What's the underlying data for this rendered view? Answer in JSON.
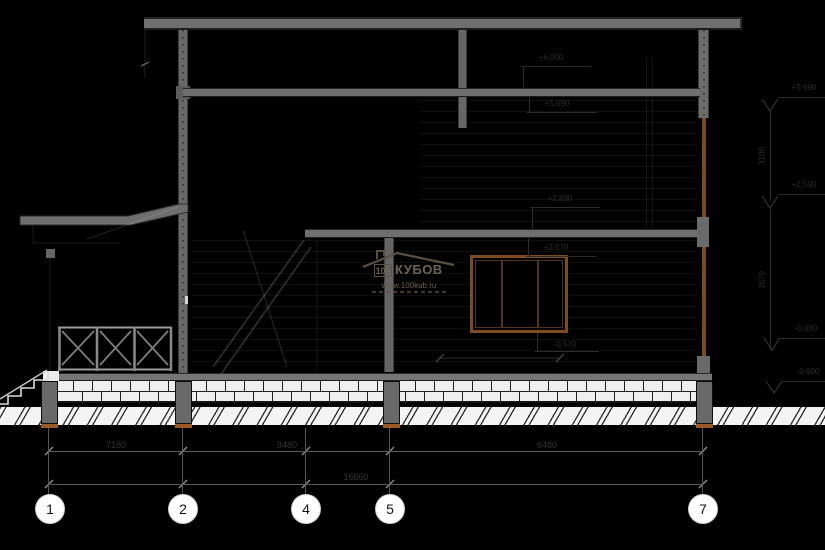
{
  "drawing": {
    "title": "building-section",
    "colors": {
      "background": "#000000",
      "concrete": "#6f6f6f",
      "masonry": "#efefef",
      "wood_window": "#7b4a1f",
      "footing_pad": "#9a5a28",
      "annotation_gray": "#2c2c2c",
      "bubble_fill": "#ffffff"
    },
    "grid_bubbles": [
      {
        "label": "1"
      },
      {
        "label": "2"
      },
      {
        "label": "4"
      },
      {
        "label": "5"
      },
      {
        "label": "7"
      }
    ],
    "dimensions": {
      "row1": [
        {
          "value": "7180"
        },
        {
          "value": "9480"
        },
        {
          "value": "6480"
        }
      ],
      "row2": [
        {
          "value": "16660"
        }
      ],
      "vertical_right": [
        {
          "value": "3100"
        },
        {
          "value": "2670"
        }
      ],
      "window_sill": {
        "value": "-0,570"
      }
    },
    "level_marks_inner": [
      {
        "text": "+6,000"
      },
      {
        "text": "+5,690"
      },
      {
        "text": "+2,890"
      },
      {
        "text": "+2,670"
      }
    ],
    "level_marks_right": [
      {
        "text": "+5,690"
      },
      {
        "text": "+2,590"
      },
      {
        "text": "-0,080"
      },
      {
        "text": "-0,600"
      }
    ],
    "watermark": {
      "number": "100",
      "brand": "КУБОВ",
      "url": "www.100kub.ru"
    }
  }
}
